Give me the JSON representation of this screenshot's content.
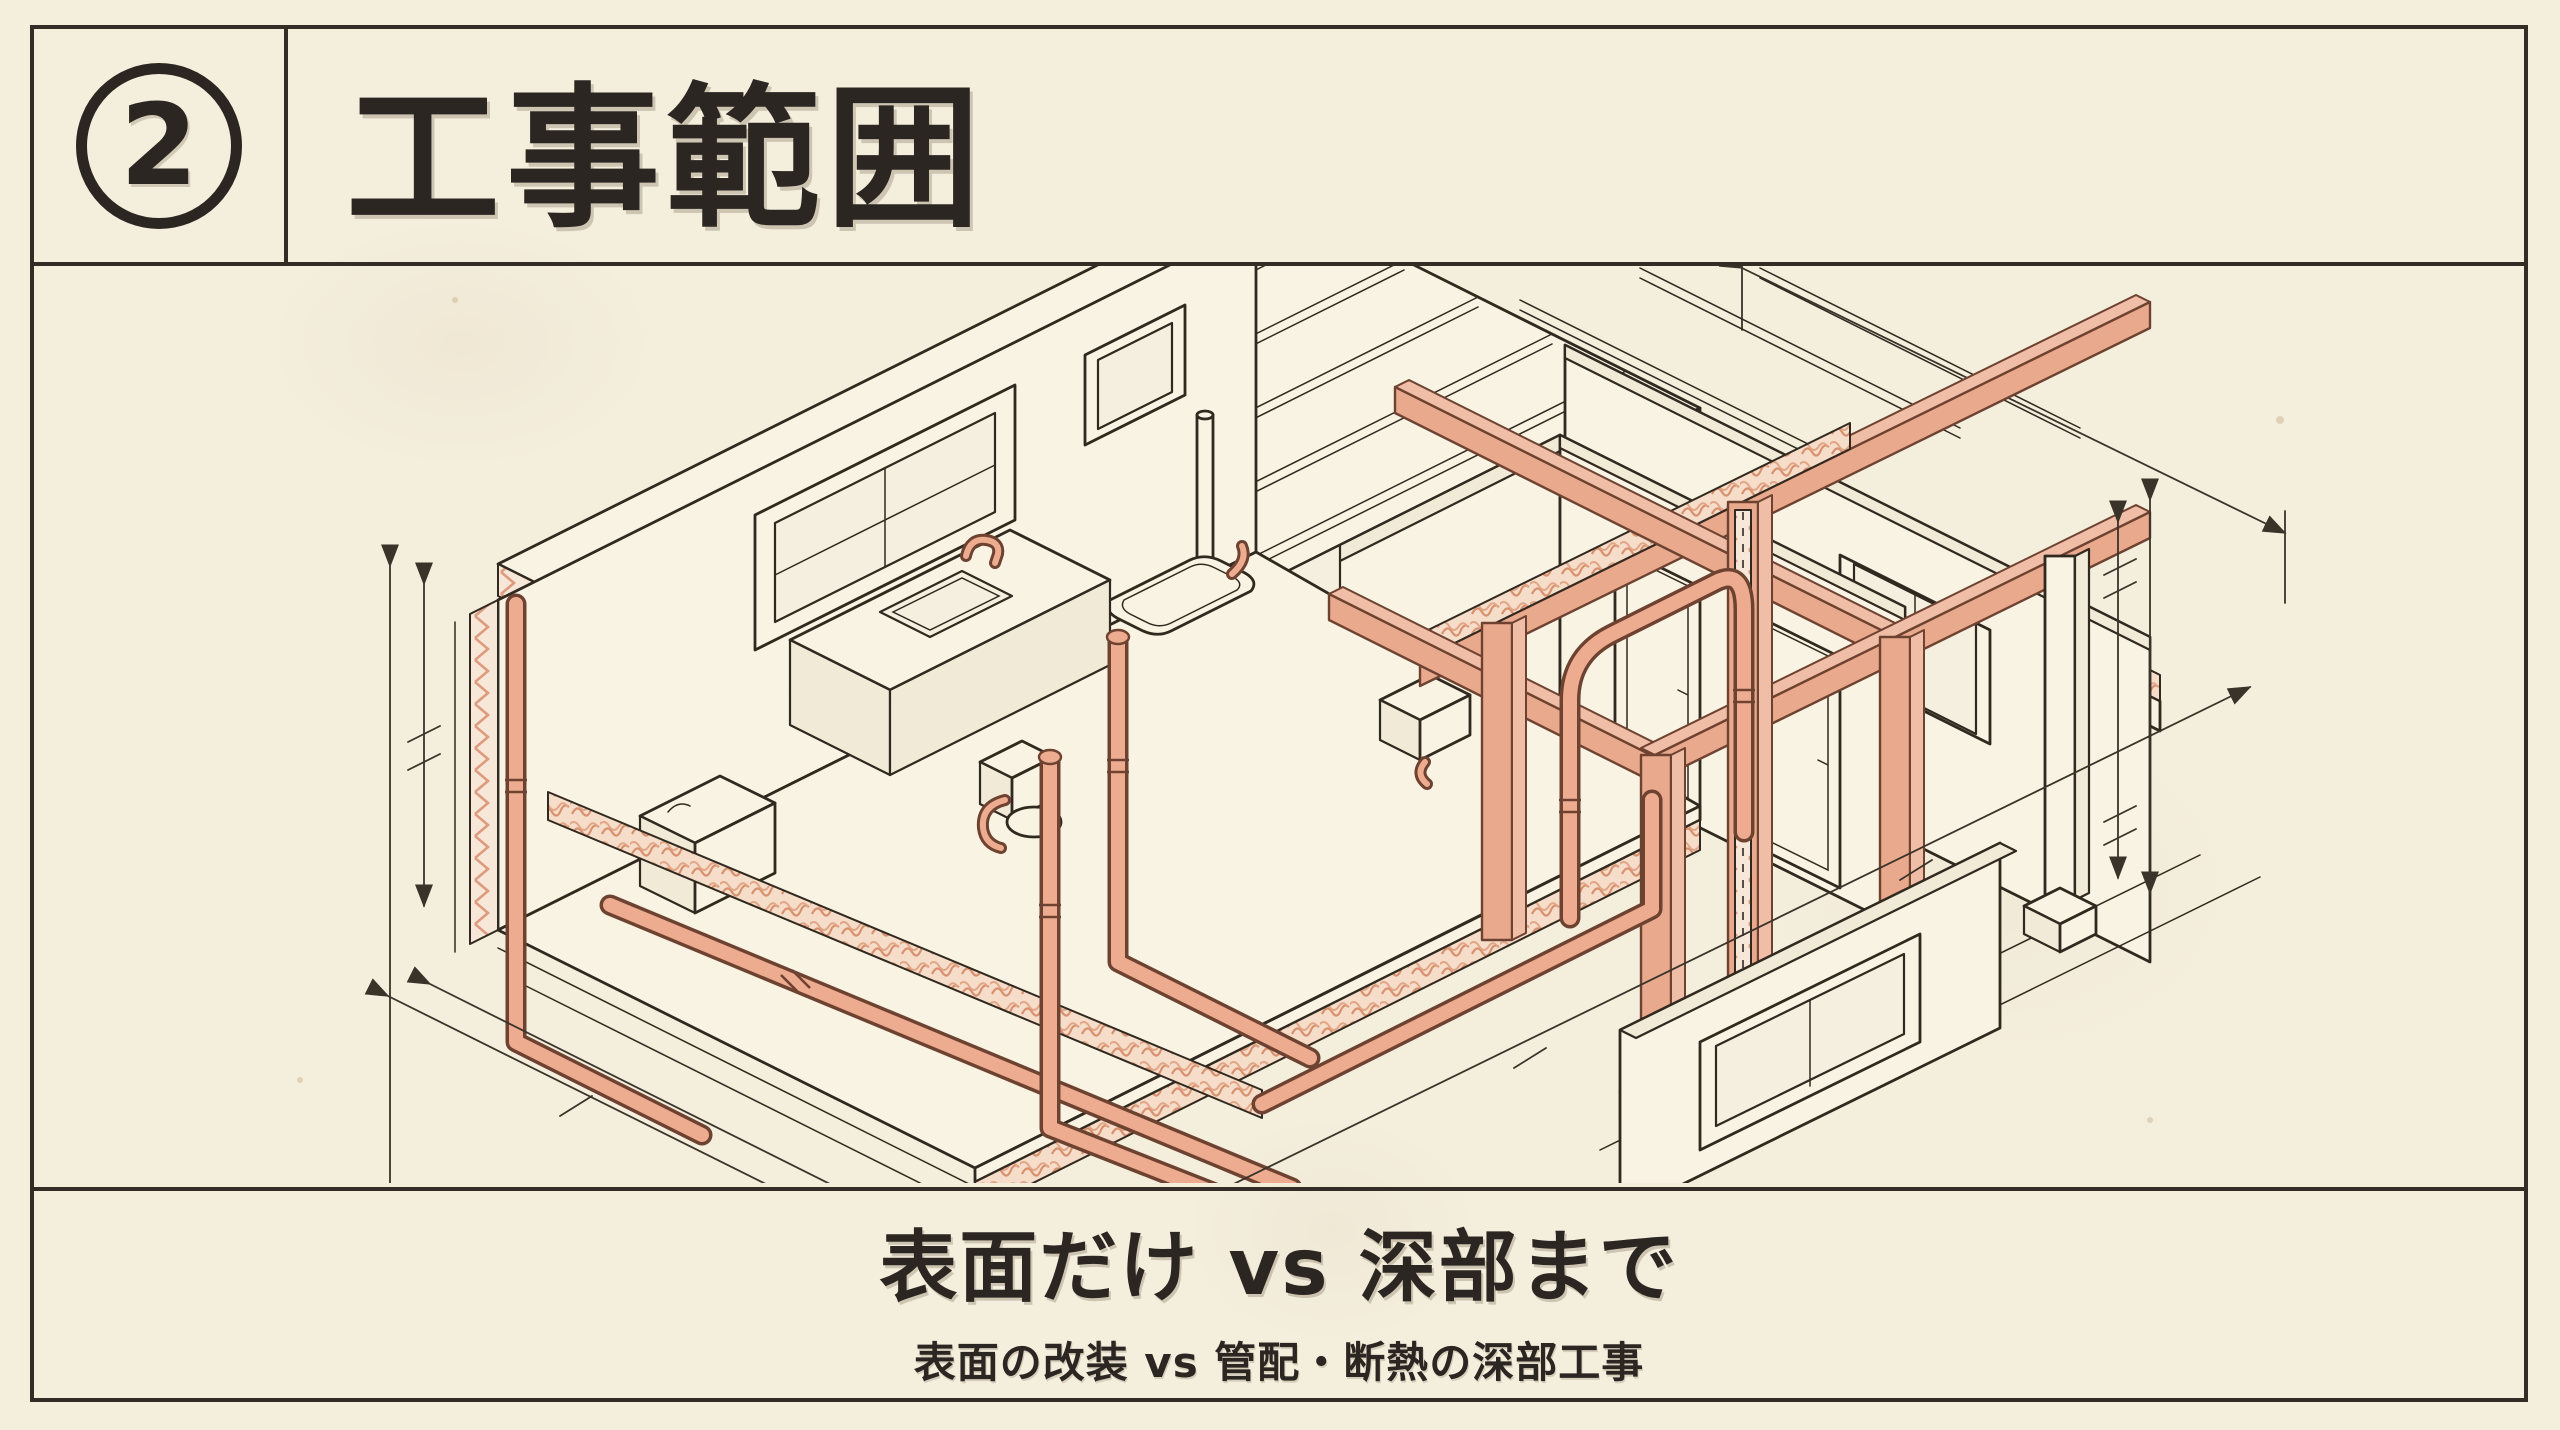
{
  "header": {
    "badge_number": "2",
    "title": "工事範囲"
  },
  "caption": {
    "heading": "表面だけ vs 深部まで",
    "subheading": "表面の改装 vs 管配・断熱の深部工事"
  },
  "illustration": {
    "type": "isometric-house-renovation-cutaway-drawing",
    "highlighted_elements": [
      "piping",
      "wall-and-ceiling-insulation",
      "timber-structural-frame"
    ],
    "fixtures": [
      "kitchen-sink",
      "bathtub",
      "toilet",
      "washbasin",
      "windows",
      "doors"
    ],
    "annotations": "unlabeled dimension lines with arrows on left, bottom and right edges"
  },
  "theme": {
    "paper": "#f4eedd",
    "panel_paper": "#f5efdf",
    "line": "#31291f",
    "frame": "#332d26",
    "text": "#2b2621",
    "hl": "#e9a98d",
    "hld": "#d98f73",
    "hll": "#f0bda7"
  }
}
